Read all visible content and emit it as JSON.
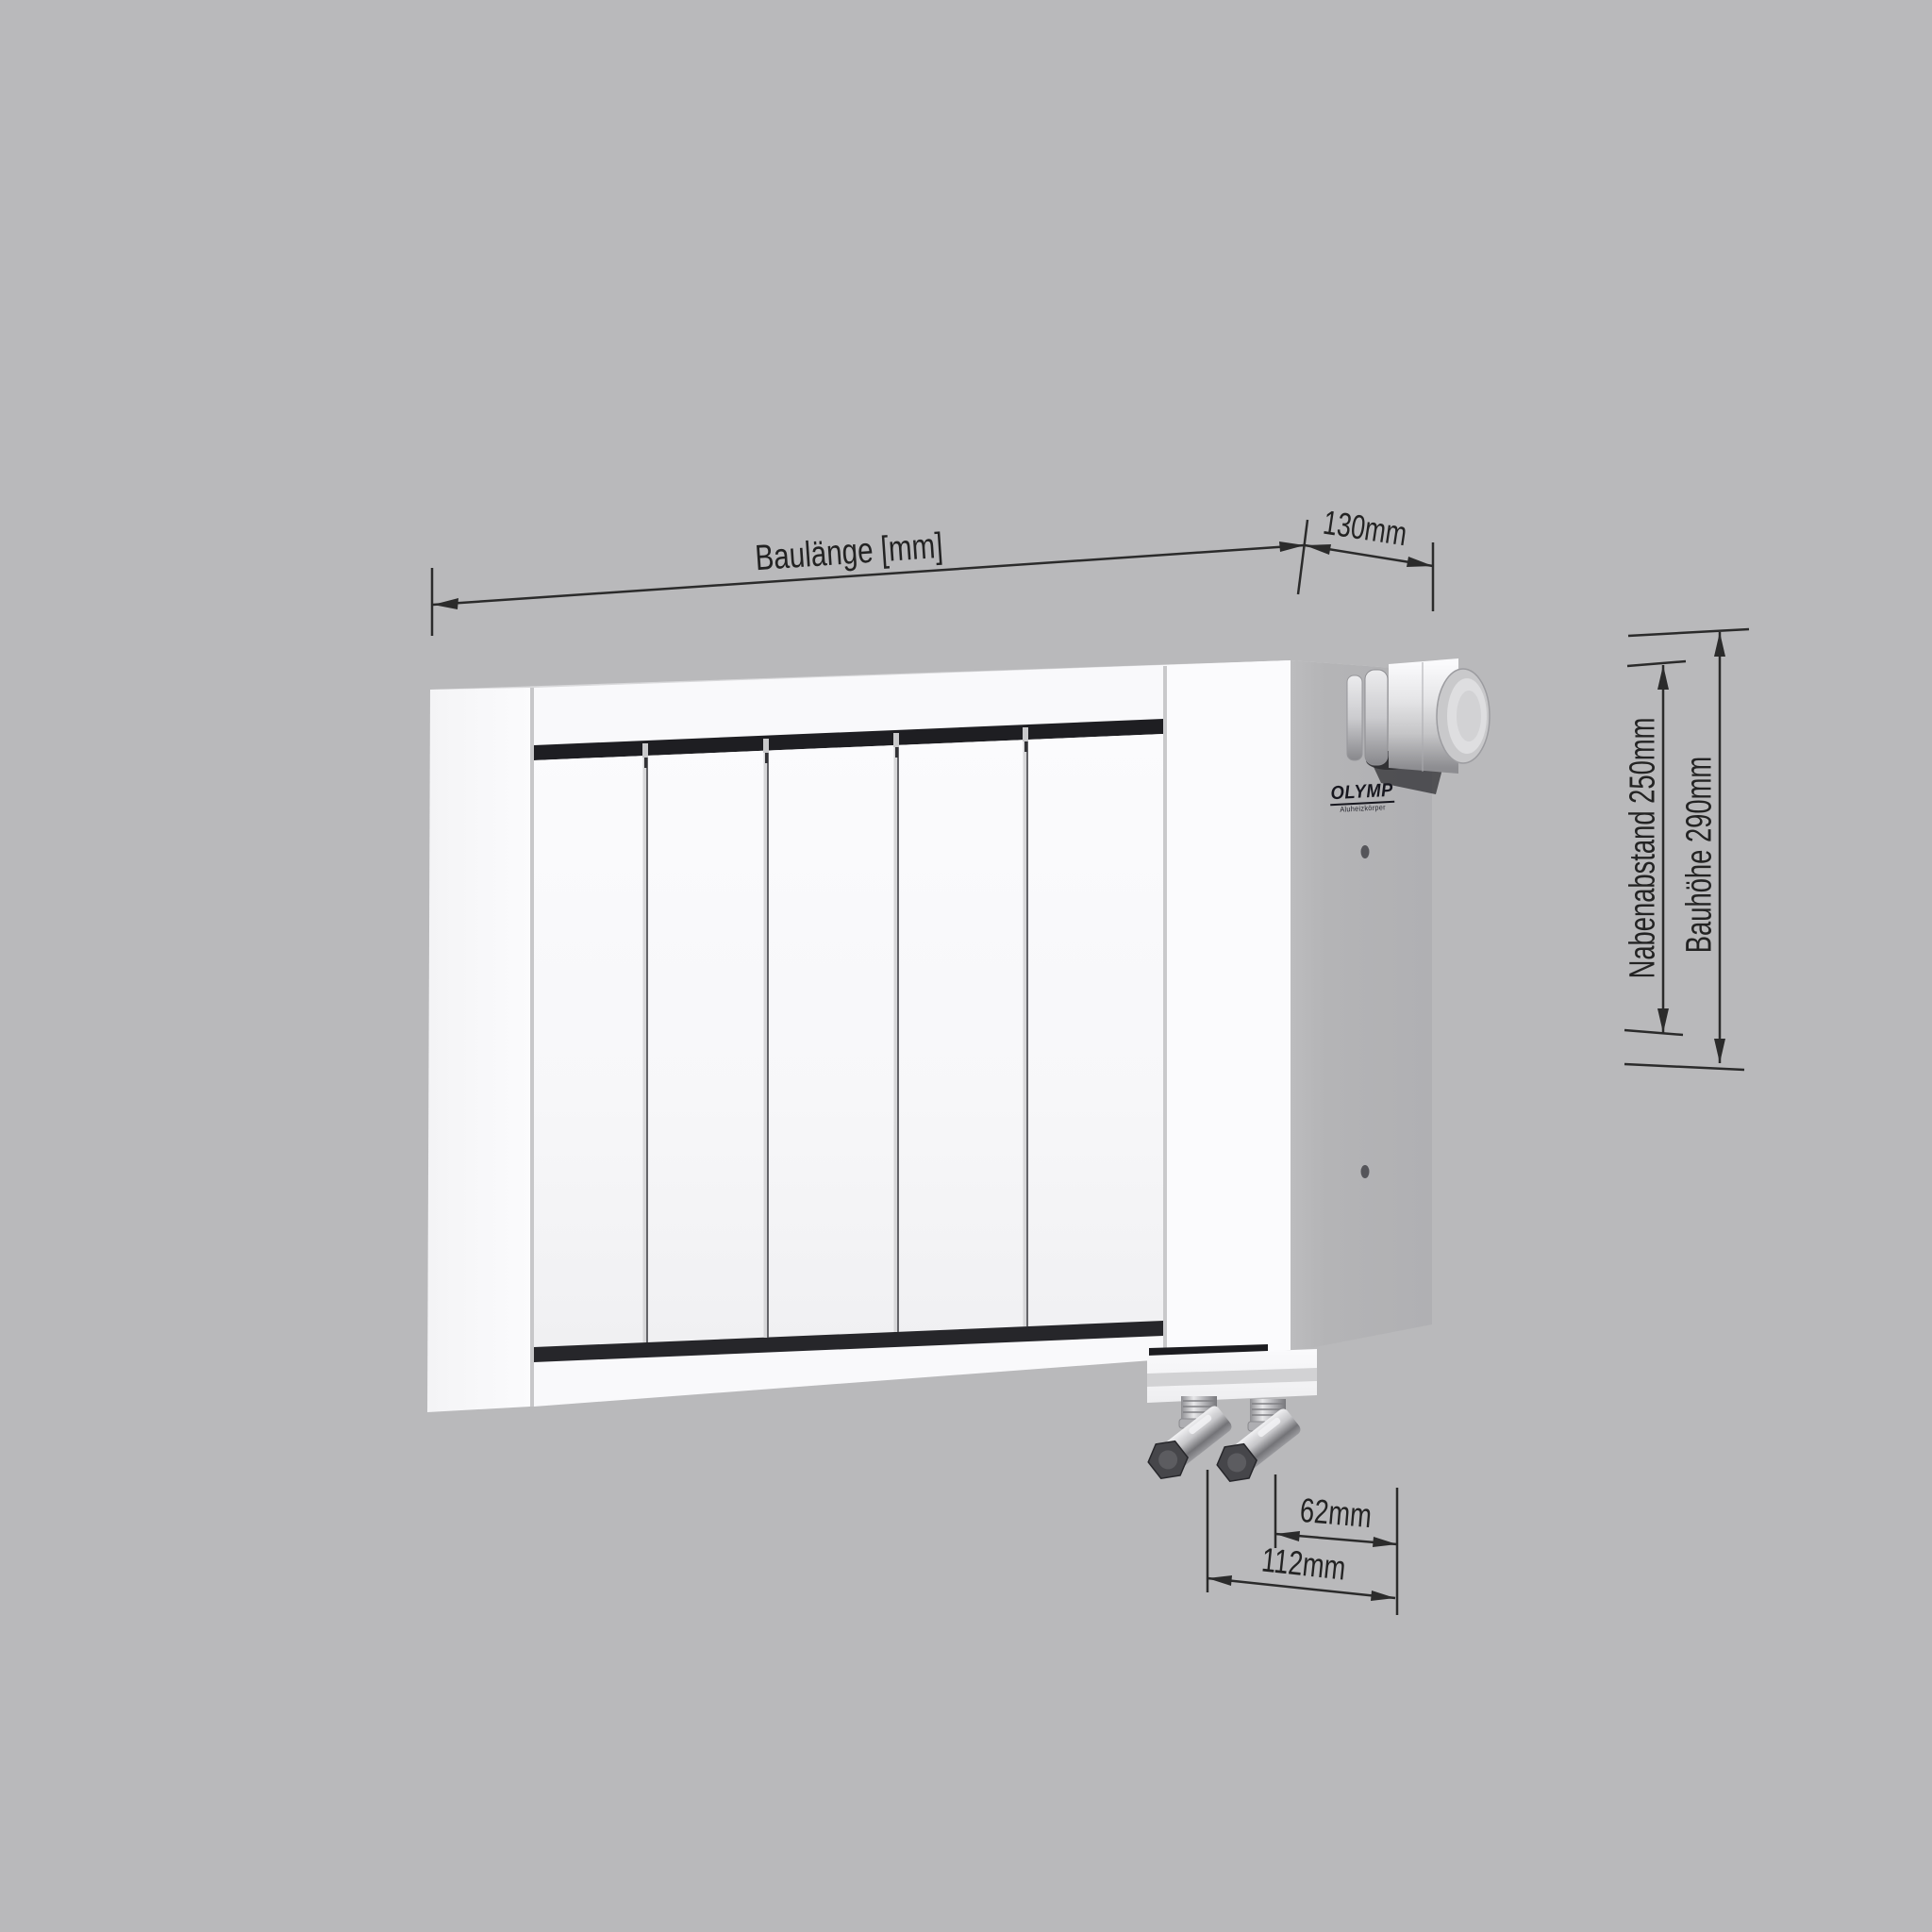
{
  "page": {
    "kind": "technical-product-drawing",
    "background_color": "#b9b9bb"
  },
  "product": {
    "type": "aluminium sectional radiator, 3D rendering",
    "brand": "OLYMP",
    "brand_subtitle": "Aluheizkörper",
    "panel_count": 5,
    "features": [
      "thermostat-knob",
      "bottom-connection-block",
      "two-valve-tails"
    ]
  },
  "annotations": {
    "length": {
      "label": "Baulänge [mm]"
    },
    "depth": {
      "label": "130mm"
    },
    "hub_distance": {
      "label": "Nabenabstand 250mm"
    },
    "overall_height": {
      "label": "Bauhöhe 290mm"
    },
    "valve_offset_inner": {
      "label": "62mm"
    },
    "valve_offset_outer": {
      "label": "112mm"
    }
  },
  "colors": {
    "background": "#b9b9bb",
    "radiator_white": "#f8f8fa",
    "side_face": "#b3b3b5",
    "top_face": "#dadadc",
    "dark_slot": "#212125",
    "dimension_line": "#2b2b2b",
    "chrome": "#cfcfd1",
    "hex_nut": "#46464a",
    "logo_color": "#17171f"
  }
}
